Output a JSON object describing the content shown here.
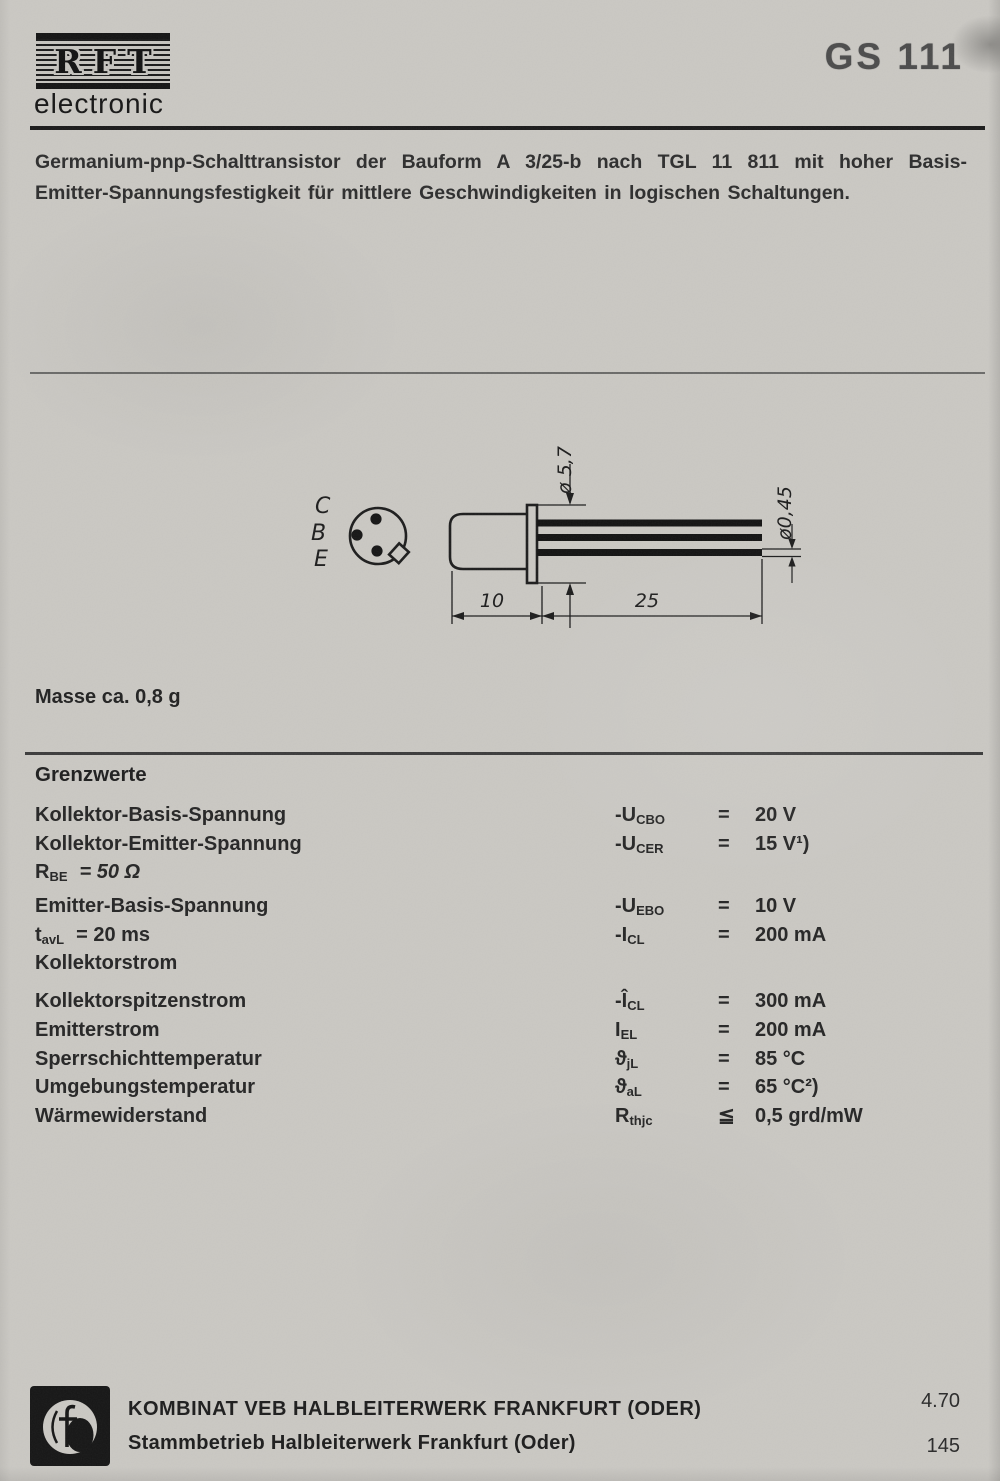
{
  "colors": {
    "paper": "#cac8c3",
    "ink": "#1d1d1d"
  },
  "brand": {
    "logo_text": "RFT",
    "sub": "electronic"
  },
  "part_number": "GS 111",
  "description": {
    "line1": "Germanium-pnp-Schalttransistor der Bauform A 3/25-b nach TGL 11 811 mit hoher Basis-",
    "line2": "Emitter-Spannungsfestigkeit für mittlere Geschwindigkeiten in logischen Schaltungen."
  },
  "drawing": {
    "pins": {
      "collector": "C",
      "base": "B",
      "emitter": "E"
    },
    "dim_flange_diameter": "ø 5,7",
    "dim_lead_diameter": "ø0,45",
    "dim_body_length": "10",
    "dim_lead_length": "25"
  },
  "mass_note": "Masse ca. 0,8 g",
  "limits": {
    "heading": "Grenzwerte",
    "rows": [
      {
        "label": "Kollektor-Basis-Spannung",
        "sym_pre": "-U",
        "sym_sub": "CBO",
        "rel": "=",
        "value": "20 V"
      },
      {
        "label": "Kollektor-Emitter-Spannung",
        "sym_pre": "-U",
        "sym_sub": "CER",
        "rel": "=",
        "value": "15 V¹)"
      },
      {
        "label_pre": "R",
        "label_sub": "BE",
        "label_rest": "=  50 Ω"
      },
      {
        "label": "Emitter-Basis-Spannung",
        "sym_pre": "-U",
        "sym_sub": "EBO",
        "rel": "=",
        "value": "10 V"
      },
      {
        "label_pre": "t",
        "label_sub": "avL",
        "label_rest": "=  20 ms",
        "sym_pre": "-I",
        "sym_sub": "CL",
        "rel": "=",
        "value": "200 mA"
      },
      {
        "label": "Kollektorstrom"
      },
      {
        "label": "Kollektorspitzenstrom",
        "sym_pre": "-Î",
        "sym_sub": "CL",
        "rel": "=",
        "value": "300 mA"
      },
      {
        "label": "Emitterstrom",
        "sym_pre": "I",
        "sym_sub": "EL",
        "rel": "=",
        "value": "200 mA"
      },
      {
        "label": "Sperrschichttemperatur",
        "sym_pre": "ϑ",
        "sym_sub": "jL",
        "rel": "=",
        "value": "85 °C"
      },
      {
        "label": "Umgebungstemperatur",
        "sym_pre": "ϑ",
        "sym_sub": "aL",
        "rel": "=",
        "value": "65 °C²)"
      },
      {
        "label": "Wärmewiderstand",
        "sym_pre": "R",
        "sym_sub": "thjc",
        "rel": "≦",
        "value": "0,5 grd/mW"
      }
    ]
  },
  "footer": {
    "company_line1": "KOMBINAT VEB HALBLEITERWERK FRANKFURT (ODER)",
    "company_line2": "Stammbetrieb Halbleiterwerk Frankfurt (Oder)",
    "date_code": "4.70",
    "page_number": "145"
  }
}
